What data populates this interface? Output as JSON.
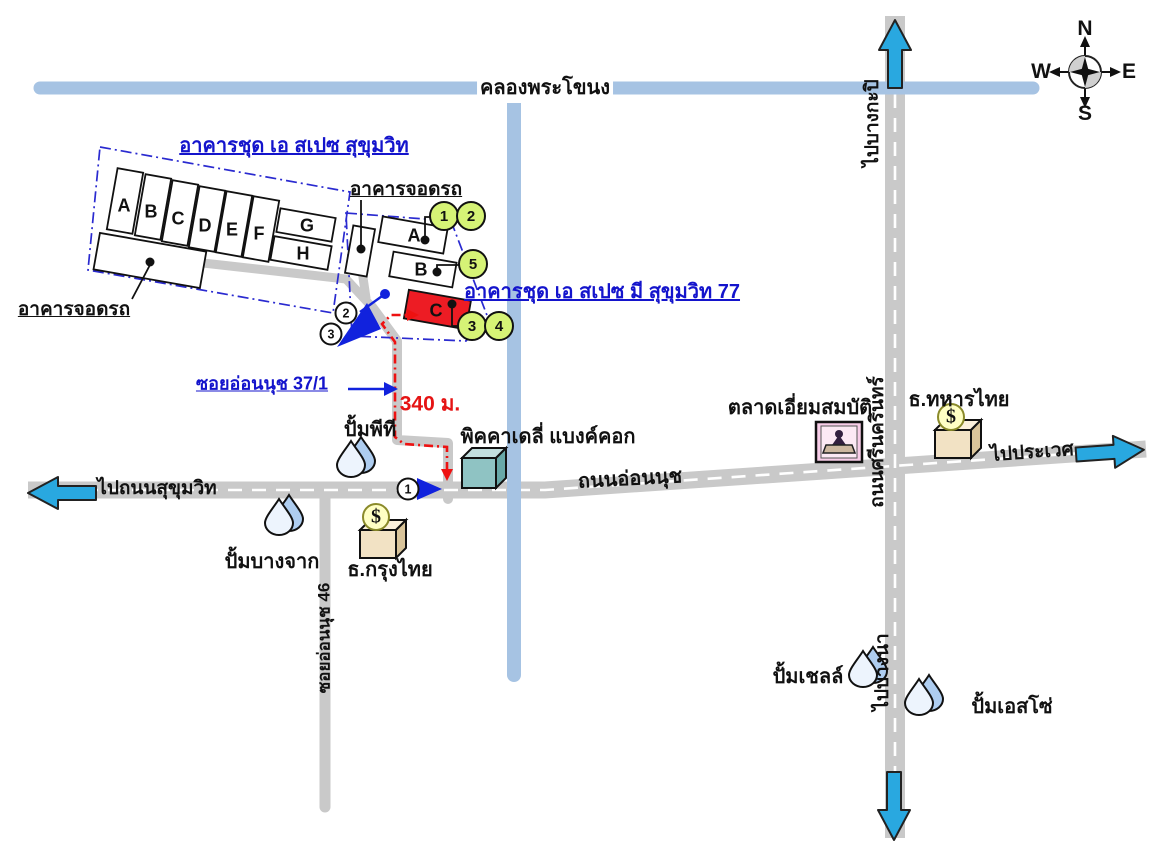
{
  "waterways": {
    "canal": "คลองพระโขนง"
  },
  "complex1": {
    "title": "อาคารชุด เอ สเปซ สุขุมวิท",
    "parking_label": "อาคารจอดรถ",
    "buildings": [
      "A",
      "B",
      "C",
      "D",
      "E",
      "F",
      "G",
      "H"
    ]
  },
  "complex2": {
    "title": "อาคารชุด เอ สเปซ มี สุขุมวิท 77",
    "parking_label": "อาคารจอดรถ",
    "buildings": [
      "A",
      "B",
      "C"
    ]
  },
  "roads": {
    "to_sukhumvit": "ไปถนนสุขุมวิท",
    "onnut": "ถนนอ่อนนุช",
    "to_prawet": "ไปประเวศ",
    "to_bangkapi": "ไปบางกะปิ",
    "srinakarin": "ถนนศรีนครินทร์",
    "to_bangna": "ไปบางนา",
    "soi_onnut_46": "ซอยอ่อนนุช 46",
    "soi_onnut_37_1": "ซอยอ่อนนุช 37/1"
  },
  "route": {
    "distance": "340 ม."
  },
  "landmarks": {
    "pt_station": "ปั้มพีที",
    "piccadilly": "พิคคาเดลี่ แบงค์คอก",
    "bangchak_station": "ปั้มบางจาก",
    "krungthai_bank": "ธ.กรุงไทย",
    "market": "ตลาดเอี่ยมสมบัติ",
    "tmb_bank": "ธ.ทหารไทย",
    "shell_station": "ปั้มเชลล์",
    "esso_station": "ปั้มเอสโซ่",
    "bank_symbol": "$"
  },
  "markers": {
    "green": [
      "1",
      "2",
      "5",
      "3",
      "4"
    ],
    "white_route": [
      "2",
      "3"
    ],
    "white_road": [
      "1"
    ]
  },
  "compass": {
    "n": "N",
    "e": "E",
    "s": "S",
    "w": "W"
  },
  "colors": {
    "canal": "#a6c3e3",
    "road": "#c9c9c9",
    "route_red": "#ee1111",
    "arrow_blue": "#29a8e0",
    "deep_blue": "#1122dd",
    "building_c_red": "#ed1c24",
    "marker_green": "#d6f376",
    "condo_text_blue": "#1414cc"
  }
}
